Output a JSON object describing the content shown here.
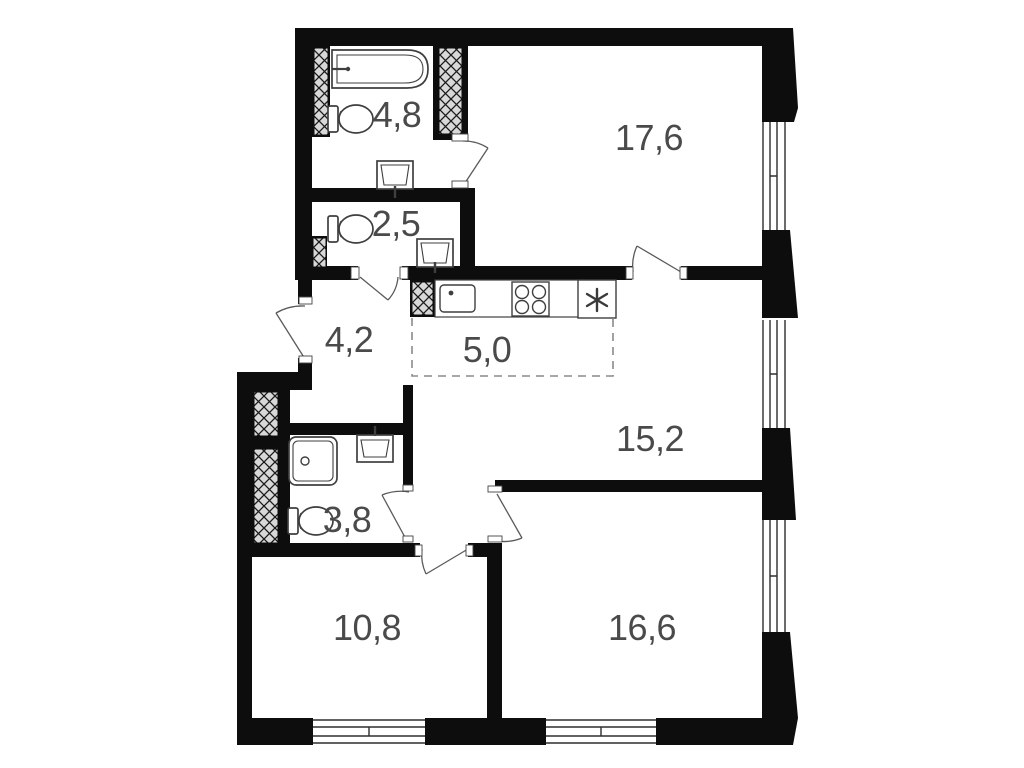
{
  "plan": {
    "type": "apartment-floor-plan",
    "rooms": [
      {
        "id": "bathroom-ensuite",
        "area": "4,8"
      },
      {
        "id": "wc",
        "area": "2,5"
      },
      {
        "id": "hallway",
        "area": "4,2"
      },
      {
        "id": "kitchen-zone",
        "area": "5,0"
      },
      {
        "id": "bedroom-master",
        "area": "17,6"
      },
      {
        "id": "living-area",
        "area": "15,2"
      },
      {
        "id": "bathroom",
        "area": "3,8"
      },
      {
        "id": "room-small",
        "area": "10,8"
      },
      {
        "id": "room-large",
        "area": "16,6"
      }
    ],
    "fixtures": [
      "bathtub",
      "toilet",
      "wash-basin",
      "shower-cabin",
      "kitchen-sink",
      "stove-4-burner",
      "refrigerator"
    ],
    "features": [
      "entry-door",
      "interior-doors",
      "windows",
      "ventilation-shafts",
      "dashed-kitchen-boundary"
    ],
    "colors": {
      "wall": "#0d0d0d",
      "background": "#ffffff",
      "label": "#4a4a4a",
      "fixture_line": "#3f3f3f",
      "door_line": "#5a5a5a",
      "dashed_zone": "#8a8a8a",
      "shaft_fill": "#d8d8d8"
    }
  }
}
